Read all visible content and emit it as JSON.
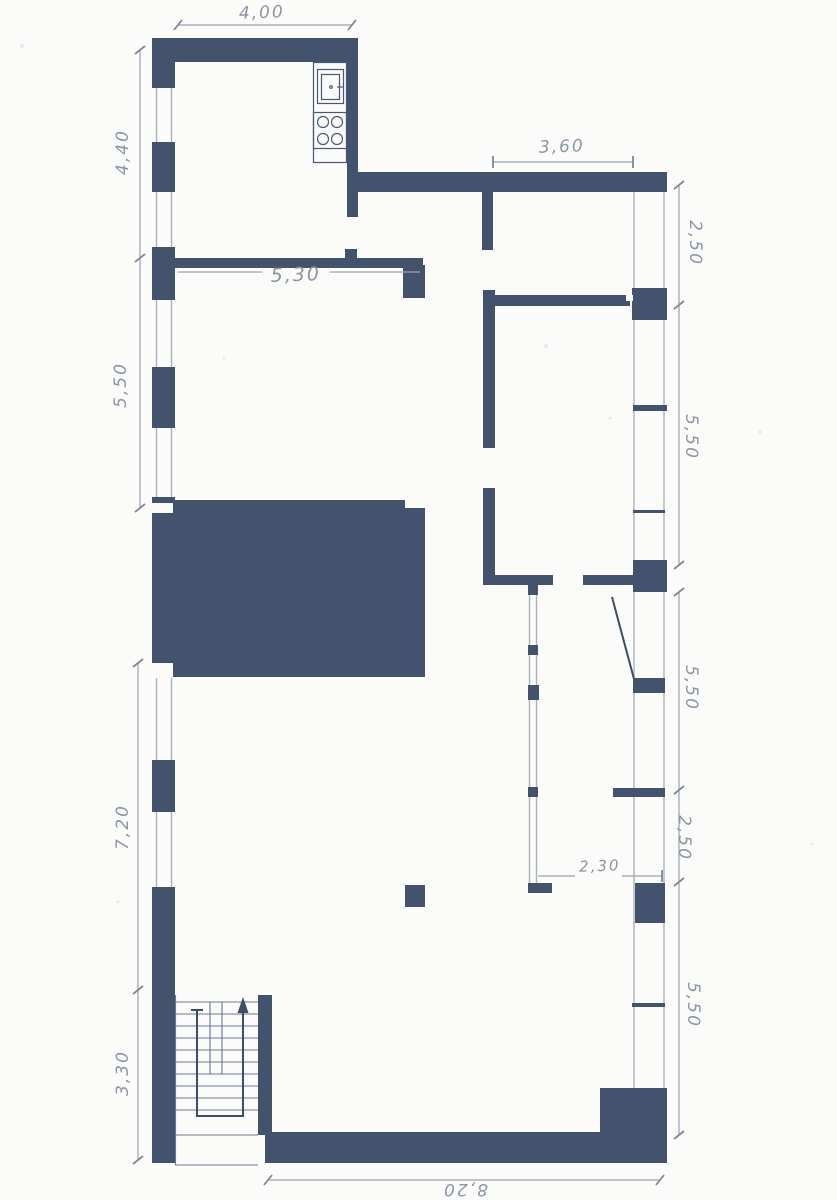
{
  "colors": {
    "wall": "#44536d",
    "paper": "#fbfbf9",
    "pencil": "#8b95a6",
    "dimline": "#9aa3b2",
    "tick": "#7f8899",
    "ink": "#3f4c68",
    "winline": "#aab1bf",
    "fixline": "#4a5878",
    "stairline": "#6a7891"
  },
  "plan": {
    "dim_top_width": "4,00",
    "dim_left": [
      "4,40",
      "5,50",
      "7,20",
      "3,30"
    ],
    "dim_right": [
      "2,50",
      "5,50",
      "5,50",
      "2,50",
      "5,50"
    ],
    "dim_bottom_width": "8,20",
    "dim_room_living": "5,30",
    "dim_room_top_right": "3,60",
    "dim_room_lower_right": "2,30"
  }
}
